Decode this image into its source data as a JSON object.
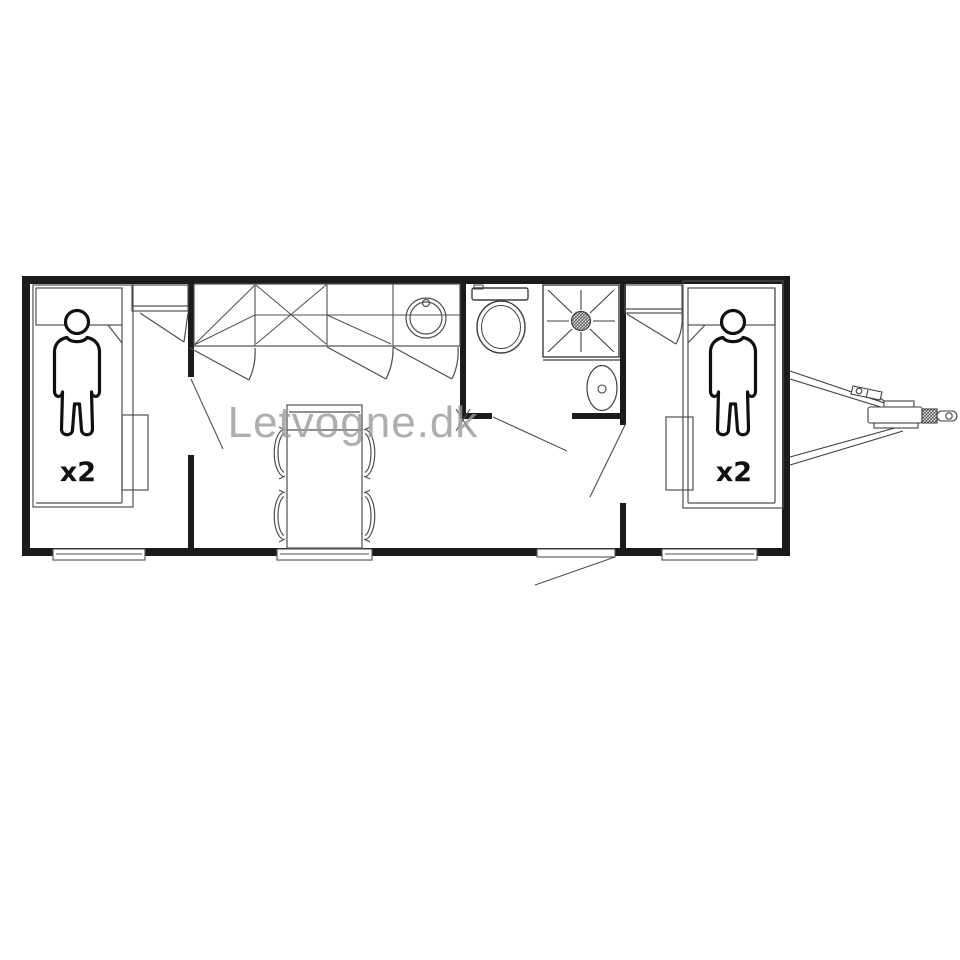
{
  "watermark": {
    "text": "Letvogne.dk",
    "color": "#9b9b9b"
  },
  "beds": {
    "left_capacity_label": "x2",
    "right_capacity_label": "x2"
  },
  "colors": {
    "wall": "#1b1b1b",
    "line": "#4f4f4f",
    "fixture": "#3f3f3f",
    "figure": "#101010",
    "label": "#111111",
    "background": "#ffffff"
  }
}
